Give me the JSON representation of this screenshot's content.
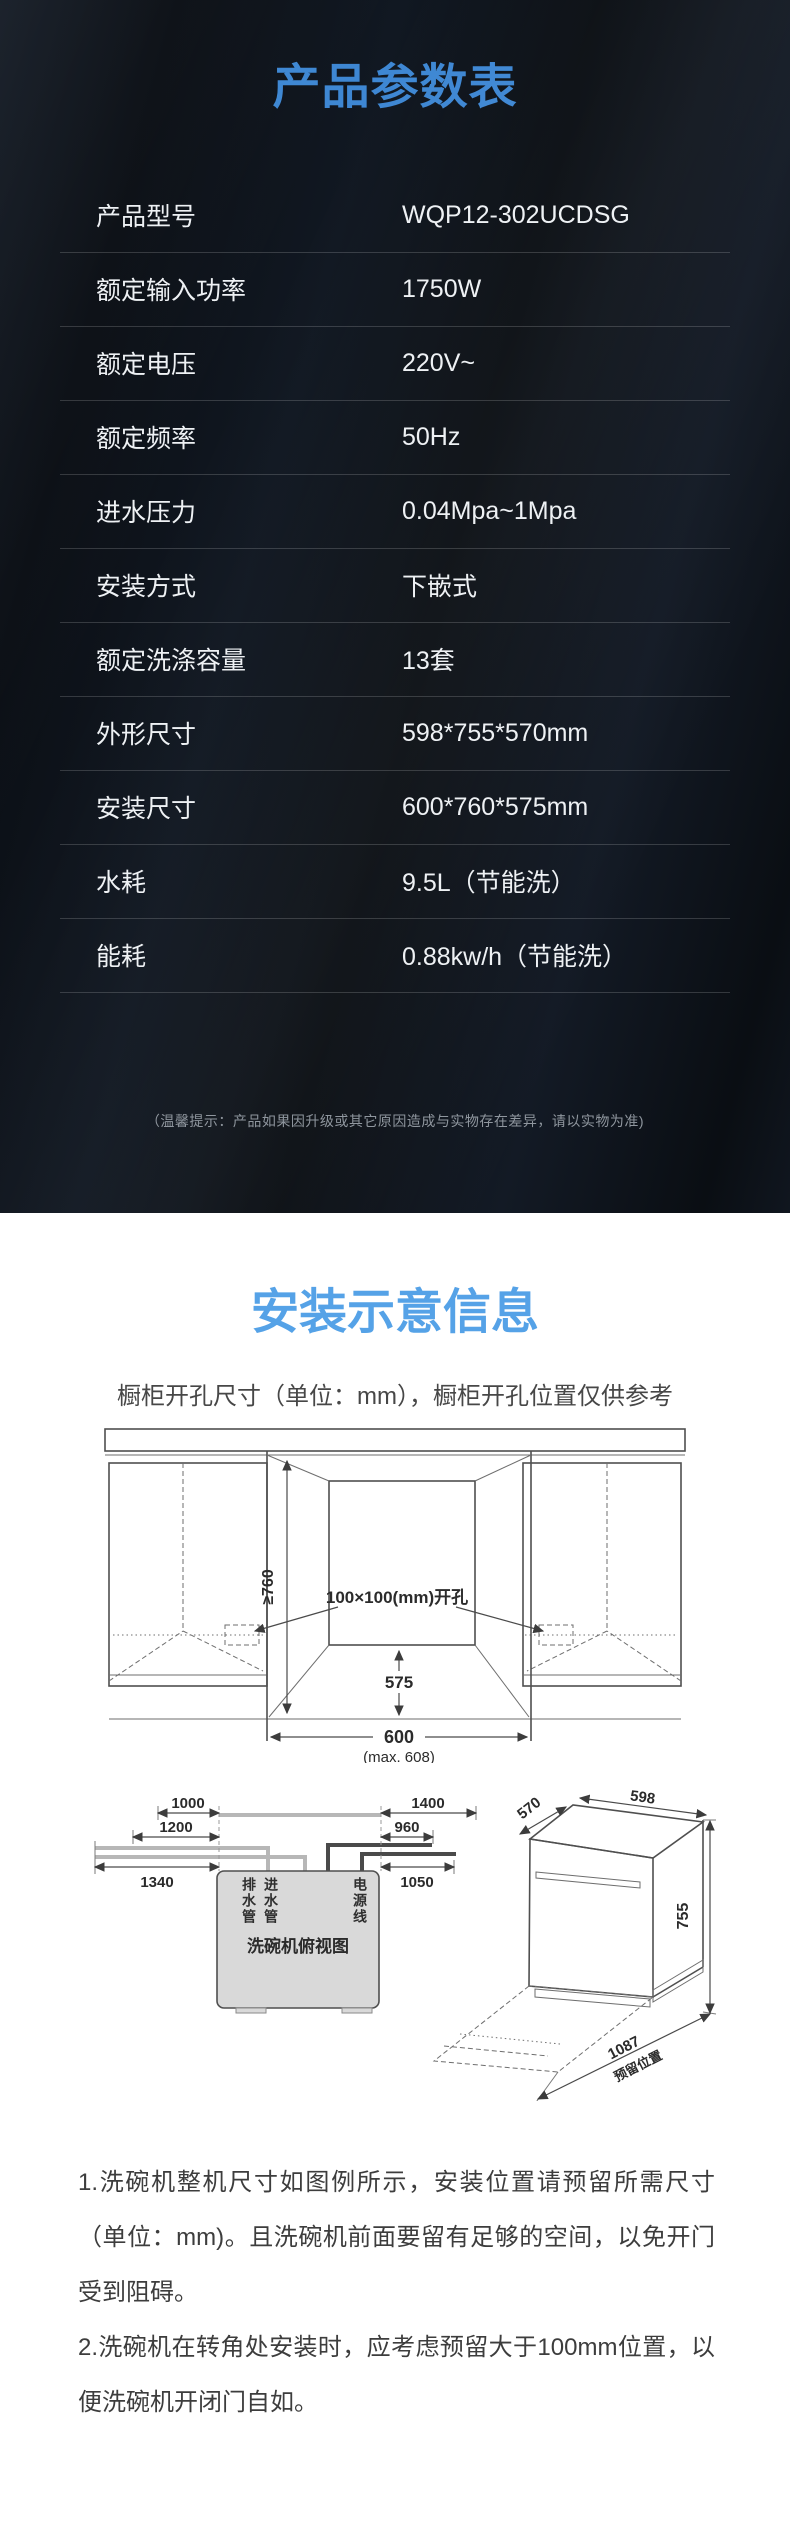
{
  "colors": {
    "dark_bg": "#0c1118",
    "spec_title_blue": "#3e87d3",
    "install_title_blue": "#55a2e7",
    "table_text": "#eef1f4",
    "divider": "rgba(255,255,255,0.17)"
  },
  "spec_section": {
    "title": "产品参数表",
    "rows": [
      {
        "label": "产品型号",
        "value": "WQP12-302UCDSG"
      },
      {
        "label": "额定输入功率",
        "value": "1750W"
      },
      {
        "label": "额定电压",
        "value": "220V~"
      },
      {
        "label": "额定频率",
        "value": "50Hz"
      },
      {
        "label": "进水压力",
        "value": "0.04Mpa~1Mpa"
      },
      {
        "label": "安装方式",
        "value": "下嵌式"
      },
      {
        "label": "额定洗涤容量",
        "value": "13套"
      },
      {
        "label": "外形尺寸",
        "value": "598*755*570mm"
      },
      {
        "label": "安装尺寸",
        "value": "600*760*575mm"
      },
      {
        "label": "水耗",
        "value": "9.5L（节能洗）"
      },
      {
        "label": "能耗",
        "value": "0.88kw/h（节能洗）"
      }
    ],
    "note": "（温馨提示：产品如果因升级或其它原因造成与实物存在差异，请以实物为准)"
  },
  "install_section": {
    "title": "安装示意信息",
    "subtitle": "橱柜开孔尺寸（单位：mm），橱柜开孔位置仅供参考",
    "cabinet_diagram": {
      "height_min": "≥760",
      "cutout_label": "100×100(mm)开孔",
      "depth": "575",
      "width": "600",
      "width_max": "(max. 608)"
    },
    "topview_diagram": {
      "dims": [
        "1000",
        "1200",
        "1340",
        "1400",
        "960",
        "1050"
      ],
      "drain_label": "排水管",
      "inlet_label": "进水管",
      "power_label": "电源线",
      "caption": "洗碗机俯视图"
    },
    "perspective_diagram": {
      "depth": "570",
      "width": "598",
      "height": "755",
      "reserved": "1087",
      "reserved_label": "预留位置"
    },
    "notes": [
      "1.洗碗机整机尺寸如图例所示，安装位置请预留所需尺寸（单位：mm)。且洗碗机前面要留有足够的空间，以免开门受到阻碍。",
      "2.洗碗机在转角处安装时，应考虑预留大于100mm位置，以便洗碗机开闭门自如。"
    ]
  }
}
